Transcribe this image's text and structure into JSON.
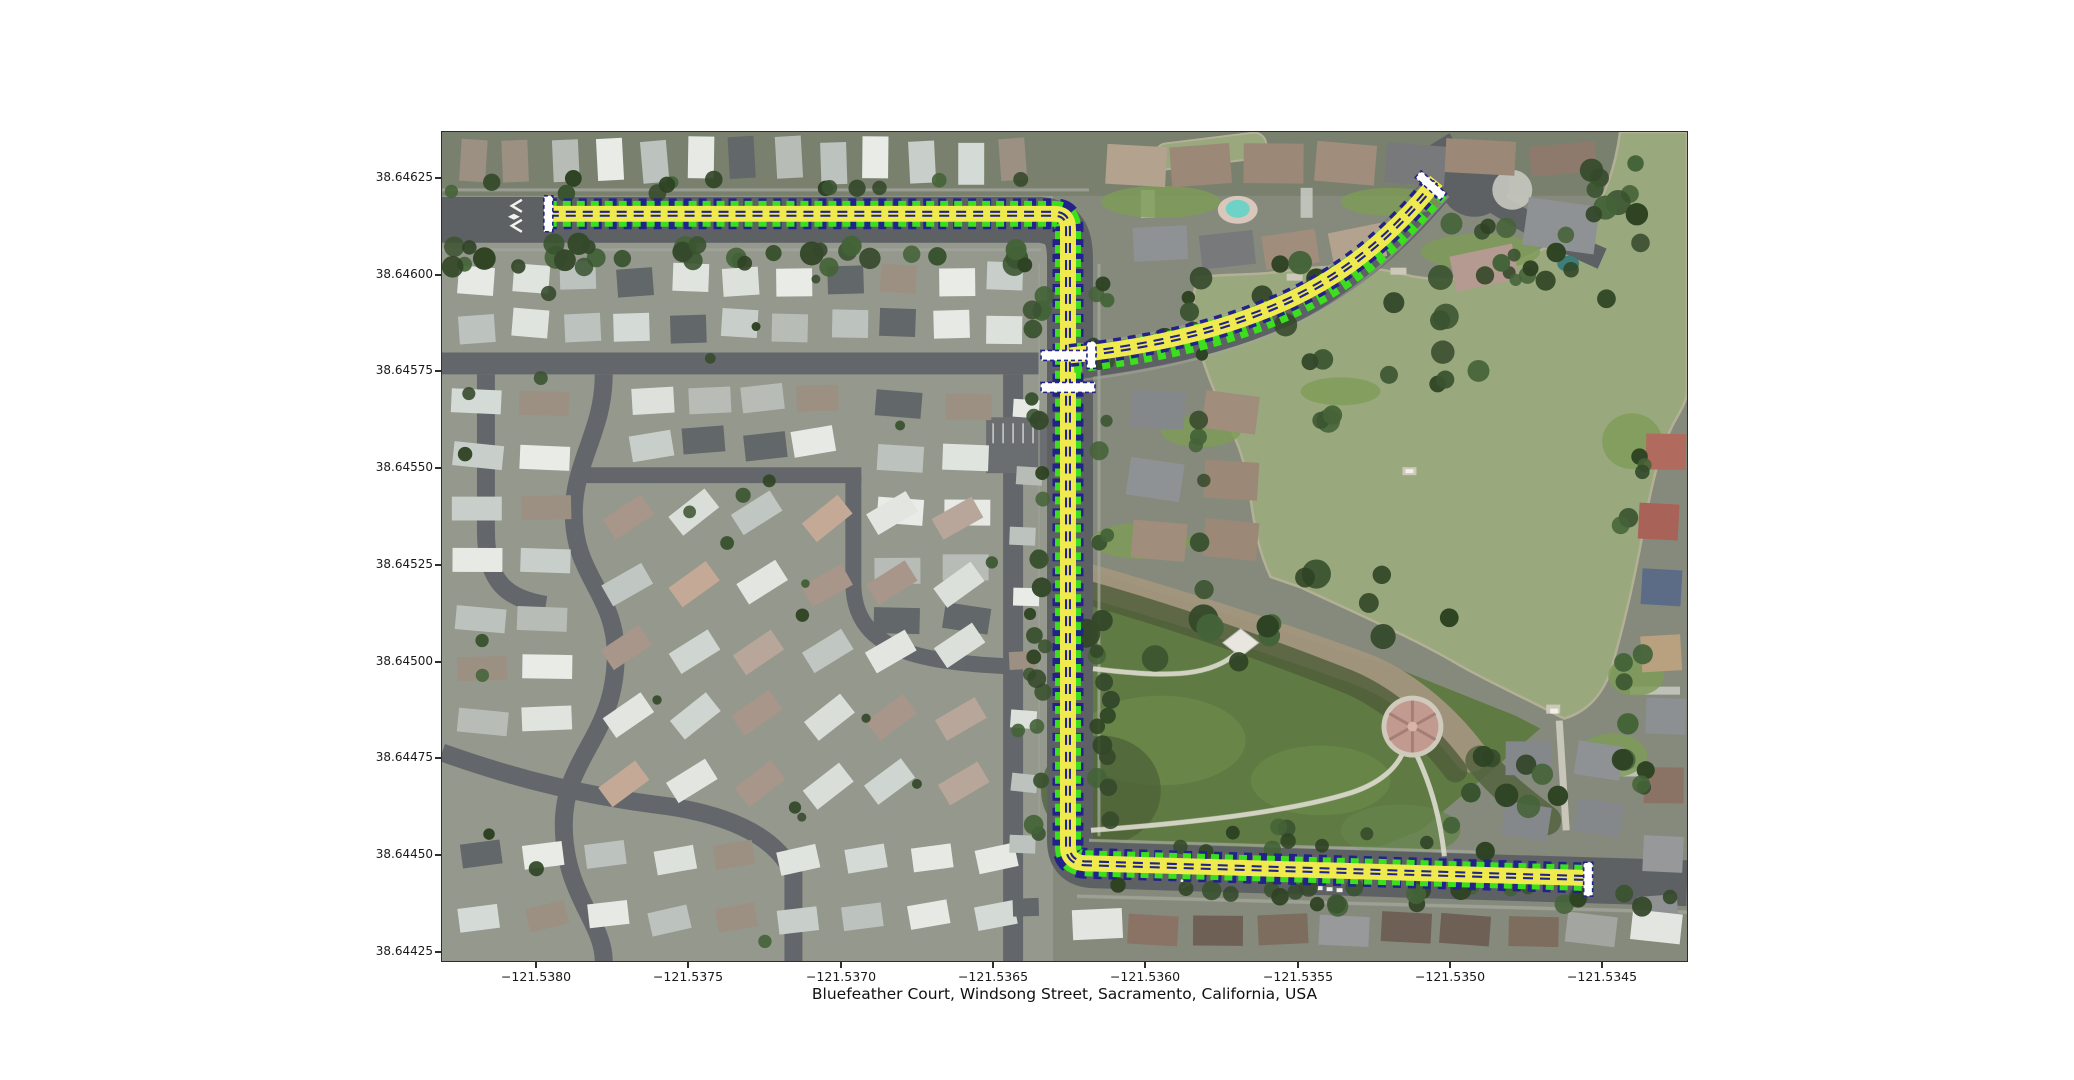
{
  "figure": {
    "title": "Bluefeather Court, Windsong Street, Sacramento, California, USA",
    "background": "#ffffff"
  },
  "axes": {
    "x_ticks": [
      "−121.5380",
      "−121.5375",
      "−121.5370",
      "−121.5365",
      "−121.5360",
      "−121.5355",
      "−121.5350",
      "−121.5345"
    ],
    "y_ticks": [
      "38.64625",
      "38.64600",
      "38.64575",
      "38.64550",
      "38.64525",
      "38.64500",
      "38.64475",
      "38.64450",
      "38.64425"
    ]
  },
  "map": {
    "type": "satellite-aerial-with-highlighted-route",
    "route": {
      "fill_color": "#efeb4e",
      "edge_dash_color": "#3bdf1d",
      "center_dash_color": "#22228a",
      "node_marker_color": "#ffffff"
    },
    "colors": {
      "water": "#9aa87e",
      "park_grass": "#5f7a42",
      "road": "#5d6164",
      "roof_light": "#e6e9e4",
      "tree": "#35492b",
      "dirt": "#a2967e"
    }
  }
}
